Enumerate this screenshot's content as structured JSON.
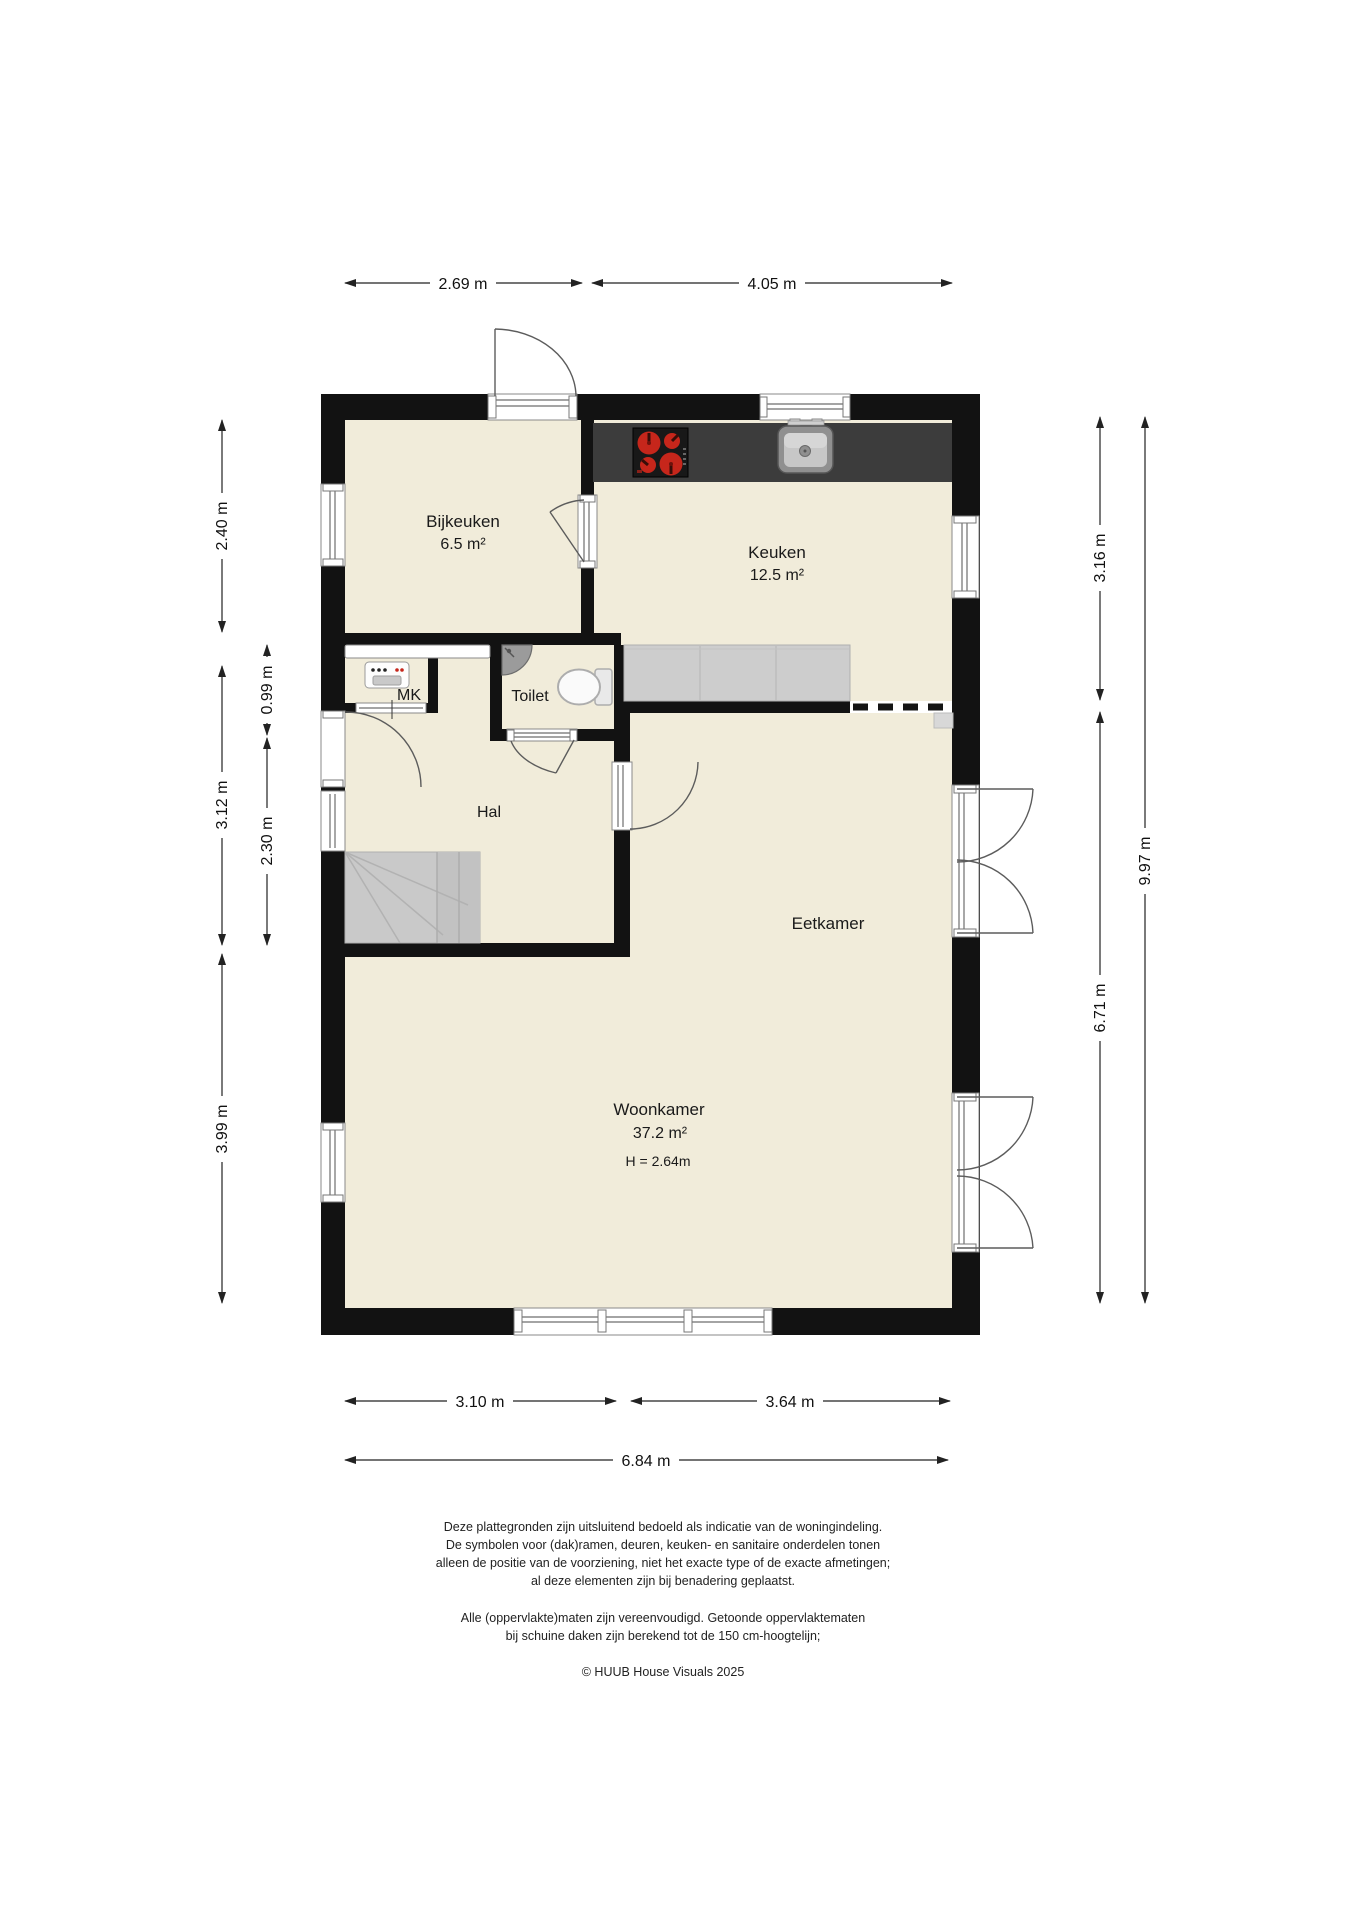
{
  "title": "Begane grond plattegrond",
  "colors": {
    "floor": "#f1ecda",
    "wall": "#121212",
    "counter_dark": "#3c3c3c",
    "counter_light": "#cdcdcd",
    "burner_red": "#c6261b",
    "stairs_gray": "#c9c9c9",
    "background": "#ffffff"
  },
  "rooms": [
    {
      "name": "Bijkeuken",
      "area": "6.5 m²"
    },
    {
      "name": "Keuken",
      "area": "12.5 m²"
    },
    {
      "name": "Toilet"
    },
    {
      "name": "MK"
    },
    {
      "name": "Hal"
    },
    {
      "name": "Eetkamer"
    },
    {
      "name": "Woonkamer",
      "area": "37.2 m²",
      "height_note": "H = 2.64m"
    }
  ],
  "dimensions": {
    "top": [
      {
        "label": "2.69 m"
      },
      {
        "label": "4.05 m"
      }
    ],
    "bottom_inner": [
      {
        "label": "3.10 m"
      },
      {
        "label": "3.64 m"
      }
    ],
    "bottom_total": {
      "label": "6.84 m"
    },
    "left_outer": [
      {
        "label": "2.40 m"
      },
      {
        "label": "3.12 m"
      },
      {
        "label": "3.99 m"
      }
    ],
    "left_inner": [
      {
        "label": "0.99 m"
      },
      {
        "label": "2.30 m"
      }
    ],
    "right_inner": [
      {
        "label": "3.16 m"
      },
      {
        "label": "6.71 m"
      }
    ],
    "right_total": {
      "label": "9.97 m"
    }
  },
  "icons": {
    "cooktop": "stove-icon",
    "kitchen_sink": "sink-icon",
    "lower_counter": "kitchen-counter",
    "toilet_bowl": "toilet-icon",
    "corner_basin": "corner-sink-icon",
    "meter_cabinet": "meter-box-icon",
    "stairs": "stairs-icon",
    "open_passage": "dashed-opening"
  },
  "footer": {
    "disclaimer": [
      "Deze plattegronden zijn uitsluitend bedoeld als indicatie van de woningindeling.",
      "De symbolen voor (dak)ramen, deuren, keuken- en sanitaire onderdelen tonen",
      "alleen de positie van de voorziening, niet het exacte type of de exacte afmetingen;",
      "al deze elementen zijn bij benadering geplaatst."
    ],
    "note": [
      "Alle (oppervlakte)maten zijn vereenvoudigd. Getoonde oppervlaktematen",
      "bij schuine daken zijn berekend tot de 150 cm-hoogtelijn;"
    ],
    "copyright": "© HUUB House Visuals 2025"
  }
}
